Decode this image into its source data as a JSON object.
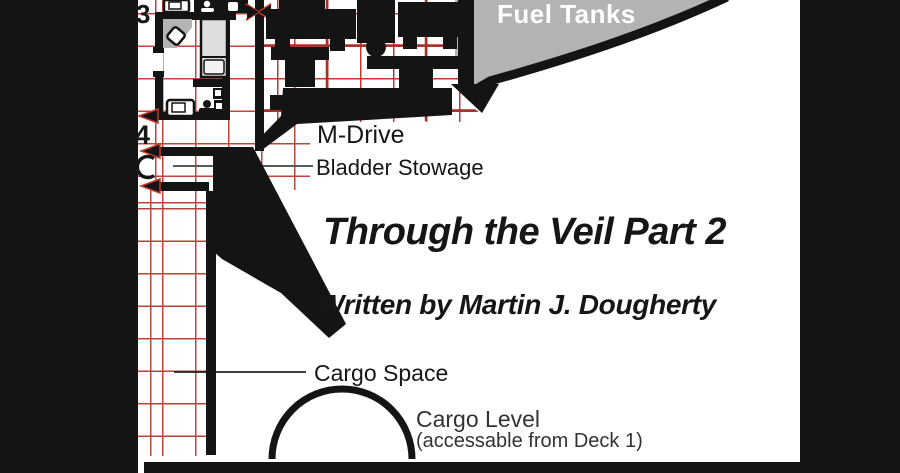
{
  "page": {
    "kind": "starship deck plan page",
    "title": "Through the Veil Part 2",
    "byline": "Written by Martin J. Dougherty"
  },
  "deck_plan": {
    "labels": {
      "fuel_tanks": "Fuel Tanks",
      "m_drive": "M-Drive",
      "bladder_stowage": "Bladder Stowage",
      "cargo_space": "Cargo Space",
      "cargo_level_line1": "Cargo Level",
      "cargo_level_line2": "(accessable from Deck 1)"
    },
    "deck_markers": {
      "upper": "3",
      "lower": "4"
    },
    "colors": {
      "hull_black": "#141414",
      "grid_red": "#c2443c",
      "fuel_tank_gray": "#b3b3b5",
      "furniture_gray": "#dedede",
      "label_gray": "#333333",
      "fuel_label_white": "#ffffff"
    }
  }
}
